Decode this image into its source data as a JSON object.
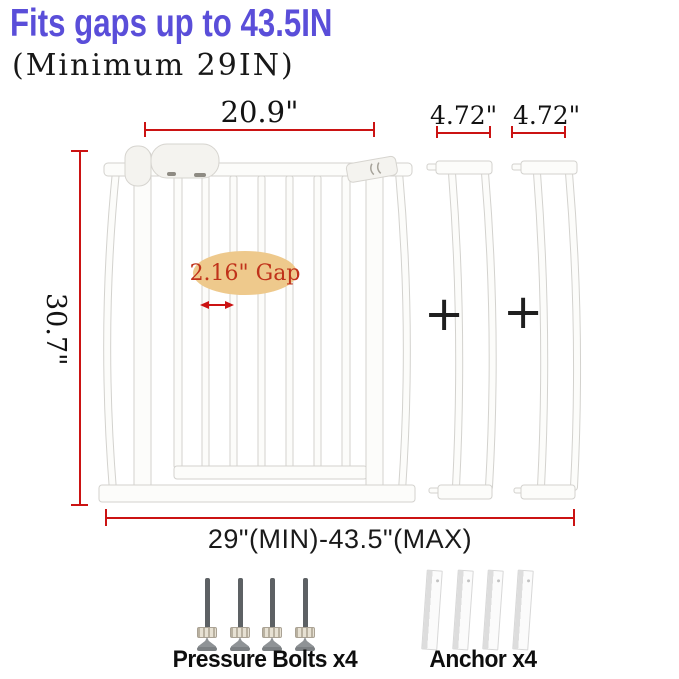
{
  "header": {
    "title": "Fits gaps up to 43.5IN",
    "subtitle": "(Minimum 29IN)"
  },
  "diagram": {
    "gate": {
      "top_width_label": "20.9\"",
      "height_label": "30.7\"",
      "gap_label": "2.16\" Gap",
      "range_label": "29\"(MIN)-43.5\"(MAX)"
    },
    "extensions": [
      {
        "width_label": "4.72\""
      },
      {
        "width_label": "4.72\""
      }
    ],
    "plus_sign": "+"
  },
  "hardware": {
    "pressure_bolts": {
      "label": "Pressure Bolts x4",
      "count": 4
    },
    "anchors": {
      "label": "Anchor x4",
      "count": 4
    }
  },
  "colors": {
    "title": "#5a4ed9",
    "dimension_line": "#cb1313",
    "gap_badge_bg": "#eec98c",
    "gap_badge_text": "#c0321a",
    "body_text": "#1a1a1a"
  }
}
